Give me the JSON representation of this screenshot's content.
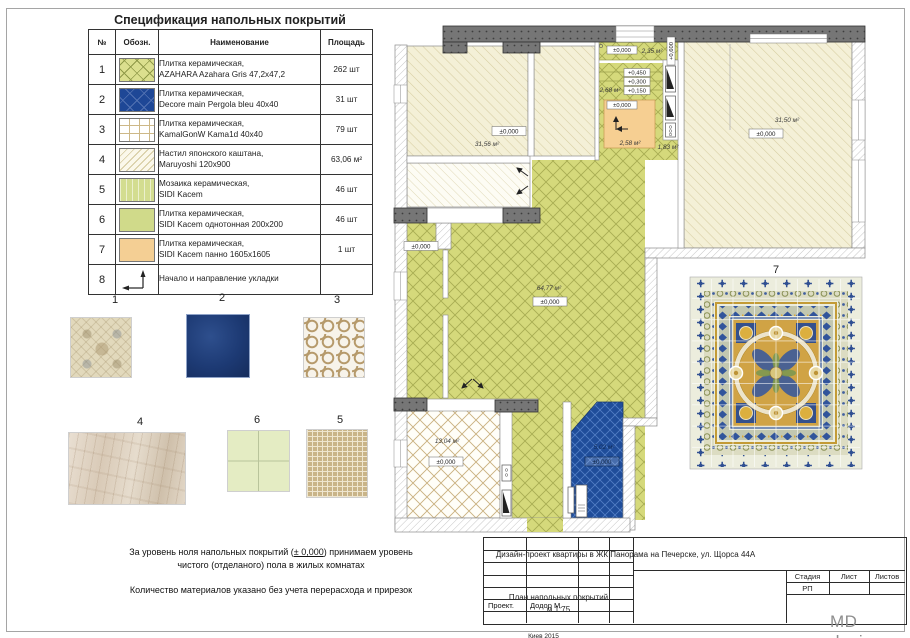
{
  "spec_table": {
    "title": "Спецификация напольных покрытий",
    "headers": {
      "num": "№",
      "symbol": "Обозн.",
      "name": "Наименование",
      "area": "Площадь"
    },
    "rows": [
      {
        "num": "1",
        "pattern": "green-lattice",
        "lines": [
          "Плитка керамическая,",
          "AZAHARA Azahara Gris 47,2x47,2"
        ],
        "qty": "262 шт"
      },
      {
        "num": "2",
        "pattern": "navy-lattice",
        "lines": [
          "Плитка керамическая,",
          "Decore main Pergola bleu 40x40"
        ],
        "qty": "31 шт"
      },
      {
        "num": "3",
        "pattern": "white-grid",
        "lines": [
          "Плитка керамическая,",
          "KamalGonW Kama1d 40x40"
        ],
        "qty": "79 шт"
      },
      {
        "num": "4",
        "pattern": "cream-hatch",
        "lines": [
          "Настил японского каштана,",
          "Maruyoshi 120x900"
        ],
        "qty": "63,06 м²"
      },
      {
        "num": "5",
        "pattern": "light-green",
        "lines": [
          "Мозаика керамическая,",
          "SIDI Kacem"
        ],
        "qty": "46 шт"
      },
      {
        "num": "6",
        "pattern": "green-plain",
        "lines": [
          "Плитка керамическая,",
          "SIDI Kacem однотонная 200x200"
        ],
        "qty": "46 шт"
      },
      {
        "num": "7",
        "pattern": "orange-plain",
        "lines": [
          "Плитка керамическая,",
          "SIDI Kacem панно 1605x1605"
        ],
        "qty": "1 шт"
      },
      {
        "num": "8",
        "pattern": "layout-arrow",
        "lines": [
          "Начало и направление укладки"
        ],
        "qty": ""
      }
    ]
  },
  "samples": {
    "n1": "1",
    "n2": "2",
    "n3": "3",
    "n4": "4",
    "n5": "5",
    "n6": "6",
    "n7": "7"
  },
  "plan": {
    "room_tl_area": "31,56 м²",
    "room_tl_level": "±0,000",
    "room_tr_area": "31,50 м²",
    "room_tr_level": "±0,000",
    "living_area": "64,77 м²",
    "living_level": "±0,000",
    "bath_area": "13,04 м²",
    "bath_level": "±0,000",
    "wc_area": "5,02 м²",
    "wc_level": "±0,000",
    "hall_level": "±0,000",
    "entry_level": "±0,000",
    "entry_area": "2,35 м²",
    "entry_side_level": "+0,600",
    "step1": "+0,450",
    "step2": "+0,300",
    "step3": "+0,150",
    "steps_area": "2,68 м²",
    "podium_level": "±0,000",
    "podium_area": "2,58 м²",
    "hall2_area": "1,83 м²",
    "panel_label": "7",
    "colors": {
      "green": "#d5d97b",
      "blue": "#1f4d9a",
      "orange": "#f6cf92",
      "wall": "#767676"
    }
  },
  "notes": {
    "line1_pre": "За уровень ноля напольных покрытий (",
    "line1_underline": "± 0,000",
    "line1_post": ") принимаем уровень",
    "line2": "чистого (отделаного) пола в жилых комнатах",
    "line3": "Количество материалов указано без учета перерасхода и прирезок"
  },
  "title_block": {
    "project": "Дизайн-проект квартиры в ЖК Панорама на Печерске, ул. Щорса 44А",
    "sheet_name": "План напольных покрытий",
    "scale": "м 1:75",
    "stage_label": "Стадия",
    "sheet_label": "Лист",
    "sheets_label": "Листов",
    "stage_value": "РП",
    "role_label": "Проект.",
    "author": "Додор М.",
    "city_year": "Киев 2015"
  },
  "logo": "MD design"
}
